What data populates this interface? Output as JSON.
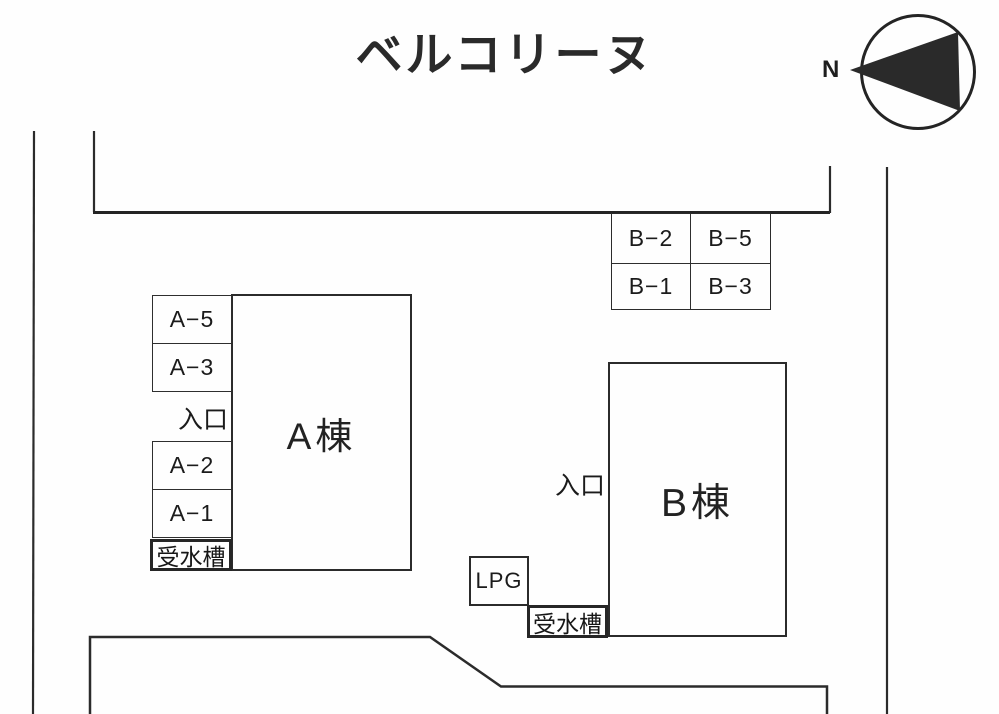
{
  "title": "ベルコリーヌ",
  "compass": {
    "north_label": "N"
  },
  "buildings": {
    "a_label": "A棟",
    "b_label": "B棟"
  },
  "parking_a": {
    "spots": [
      "A−5",
      "A−3",
      "A−2",
      "A−1"
    ],
    "entrance": "入口",
    "water_tank": "受水槽"
  },
  "parking_b": {
    "cells": [
      "B−2",
      "B−5",
      "B−1",
      "B−3"
    ],
    "entrance": "入口",
    "lpg": "LPG",
    "water_tank": "受水槽"
  },
  "colors": {
    "ink": "#2b2b2b",
    "background": "#fefefe"
  }
}
